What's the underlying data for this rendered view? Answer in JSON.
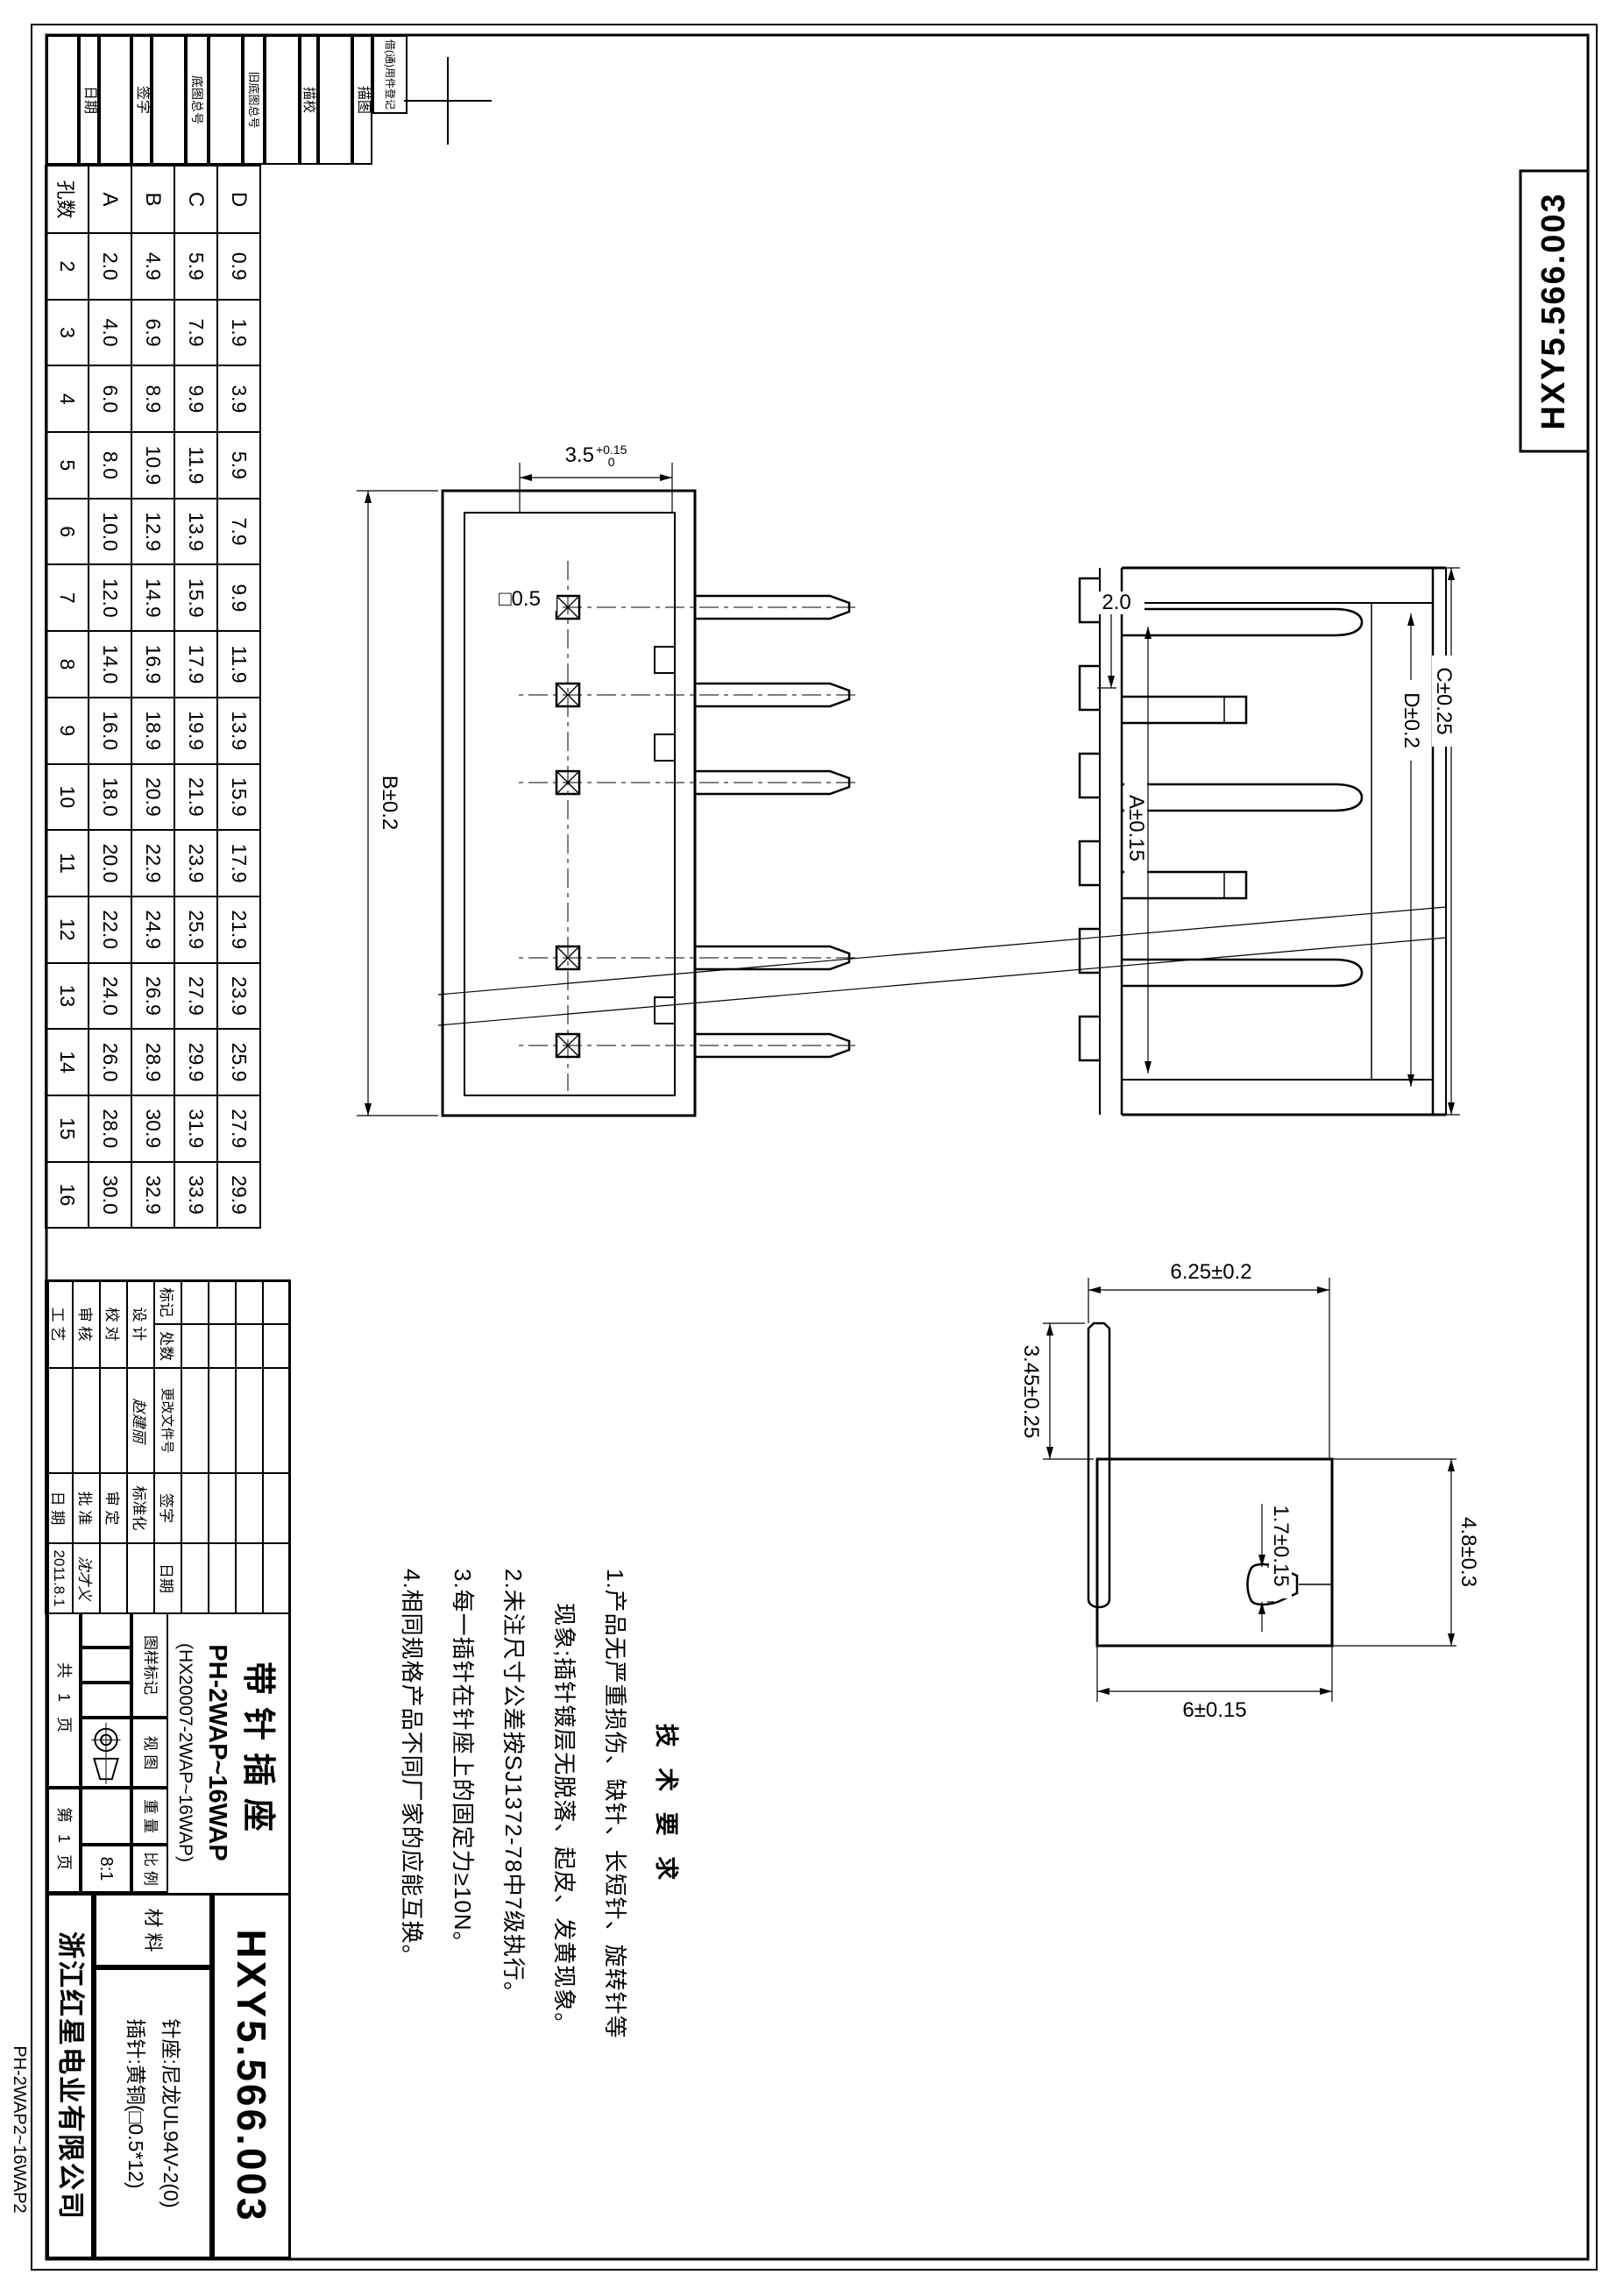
{
  "doc": {
    "drawing_no": "HXY5.566.003",
    "company": "浙江红星电业有限公司",
    "title": "带针插座",
    "model": "PH-2WAP~16WAP",
    "model_alt": "(HX20007-2WAP~16WAP)",
    "margin_code": "PH-2WAP2~16WAP2"
  },
  "margin_strip": {
    "labels": [
      "借(通)用件登记",
      "描图",
      "描校",
      "旧底图总号",
      "底图总号",
      "签字",
      "日期"
    ]
  },
  "param_table": {
    "row_headers": [
      "D",
      "C",
      "B",
      "A",
      "孔数"
    ],
    "row_values": [
      [
        "0.9",
        "1.9",
        "3.9",
        "5.9",
        "7.9",
        "9.9",
        "11.9",
        "13.9",
        "15.9",
        "17.9",
        "21.9",
        "23.9",
        "25.9",
        "27.9",
        "29.9"
      ],
      [
        "5.9",
        "7.9",
        "9.9",
        "11.9",
        "13.9",
        "15.9",
        "17.9",
        "19.9",
        "21.9",
        "23.9",
        "25.9",
        "27.9",
        "29.9",
        "31.9",
        "33.9"
      ],
      [
        "4.9",
        "6.9",
        "8.9",
        "10.9",
        "12.9",
        "14.9",
        "16.9",
        "18.9",
        "20.9",
        "22.9",
        "24.9",
        "26.9",
        "28.9",
        "30.9",
        "32.9"
      ],
      [
        "2.0",
        "4.0",
        "6.0",
        "8.0",
        "10.0",
        "12.0",
        "14.0",
        "16.0",
        "18.0",
        "20.0",
        "22.0",
        "24.0",
        "26.0",
        "28.0",
        "30.0"
      ],
      [
        "2",
        "3",
        "4",
        "5",
        "6",
        "7",
        "8",
        "9",
        "10",
        "11",
        "12",
        "13",
        "14",
        "15",
        "16"
      ]
    ]
  },
  "title_block": {
    "rev_header": [
      "标记",
      "处数",
      "更改文件号",
      "签字",
      "日期"
    ],
    "sign_rows": [
      {
        "label": "设 计",
        "name": "赵建丽",
        "label2": "标准化",
        "name2": ""
      },
      {
        "label": "校 对",
        "name": "",
        "label2": "审 定",
        "name2": ""
      },
      {
        "label": "审 核",
        "name": "",
        "label2": "批 准",
        "name2": "沈才义"
      },
      {
        "label": "工 艺",
        "name": "",
        "label2": "日 期",
        "name2": "2011.8.1"
      }
    ],
    "marks_label": "图样标记",
    "view_label": "视 图",
    "weight_label": "重 量",
    "scale_label": "比 例",
    "scale_value": "8:1",
    "sheets_total": "共 1 页",
    "sheet_no": "第 1 页",
    "material_label": "材 料",
    "material_line1": "针座:尼龙UL94V-2(0)",
    "material_line2": "插针:黄铜(□0.5*12)"
  },
  "tech": {
    "heading": "技 术 要 求",
    "lines": [
      "1.产品无严重损伤、缺针、长短针、旋转针等",
      "现象;插针镀层无脱落、起皮、发黄现象。",
      "2.未注尺寸公差按SJ1372-78中7级执行。",
      "3.每一插针在针座上的固定力≥10N。",
      "4.相同规格产品不同厂家的应能互换。"
    ]
  },
  "dims": {
    "front_pitch": "3.5",
    "front_pitch_tol_up": "+0.15",
    "front_pitch_tol_dn": "0",
    "front_length": "B±0.2",
    "front_pin_square": "□0.5",
    "side_outer": "C±0.25",
    "side_inner": "D±0.2",
    "side_span": "A±0.15",
    "side_pitch": "2.0",
    "detail_height": "6.25±0.2",
    "detail_tip": "3.45±0.25",
    "detail_bullet": "1.7±0.15",
    "detail_width": "4.8±0.3",
    "detail_body": "6±0.15"
  }
}
